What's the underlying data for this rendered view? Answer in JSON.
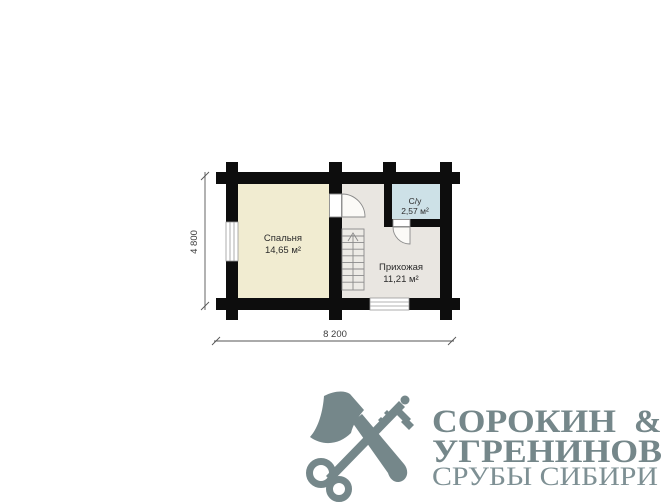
{
  "floor_plan": {
    "wall_color": "#0d0d0d",
    "rooms": [
      {
        "name": "Спальня",
        "area": "14,65 м²",
        "color": "#f1ecd1"
      },
      {
        "name": "Прихожая",
        "area": "11,21 м²",
        "color": "#e9e6e1"
      },
      {
        "name": "С/у",
        "area": "2,57 м²",
        "color": "#cde1e7"
      }
    ],
    "dimensions": {
      "horizontal": "8 200",
      "vertical": "4 800"
    }
  },
  "logo": {
    "icon": "crossed-axe-and-key",
    "color": "#75878a",
    "tagline_color": "#7e9094",
    "name_line1": "СОРОКИН",
    "ampersand": "&",
    "name_line2": "УГРЕНИНОВ",
    "tagline": "СРУБЫ СИБИРИ"
  }
}
